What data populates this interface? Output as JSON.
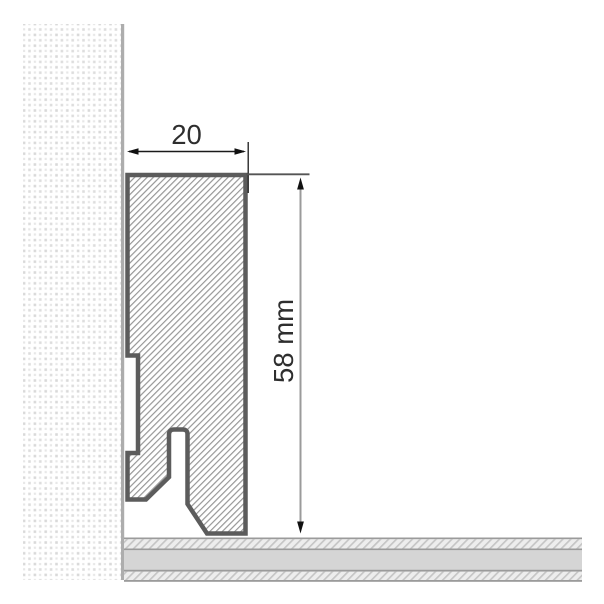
{
  "diagram": {
    "type": "technical-cross-section",
    "subject": "skirting-board-profile-on-wall-and-floor",
    "dimensions": {
      "width_label": "20",
      "width_value": 20,
      "height_label": "58 mm",
      "height_value": 58,
      "height_unit": "mm"
    },
    "colors": {
      "background": "#ffffff",
      "profile_outline": "#5c5c5c",
      "profile_hatch": "#939393",
      "wall_dot": "#dcdcdc",
      "wall_edge": "#adadad",
      "floor_line": "#9b9b9b",
      "floor_fill": "#d5d5d5",
      "floor_hatch": "#c5c5c5",
      "dimension_line": "#1a1a1a",
      "dimension_leader": "#9b9b9b",
      "dimension_text": "#2e2e2e"
    }
  }
}
